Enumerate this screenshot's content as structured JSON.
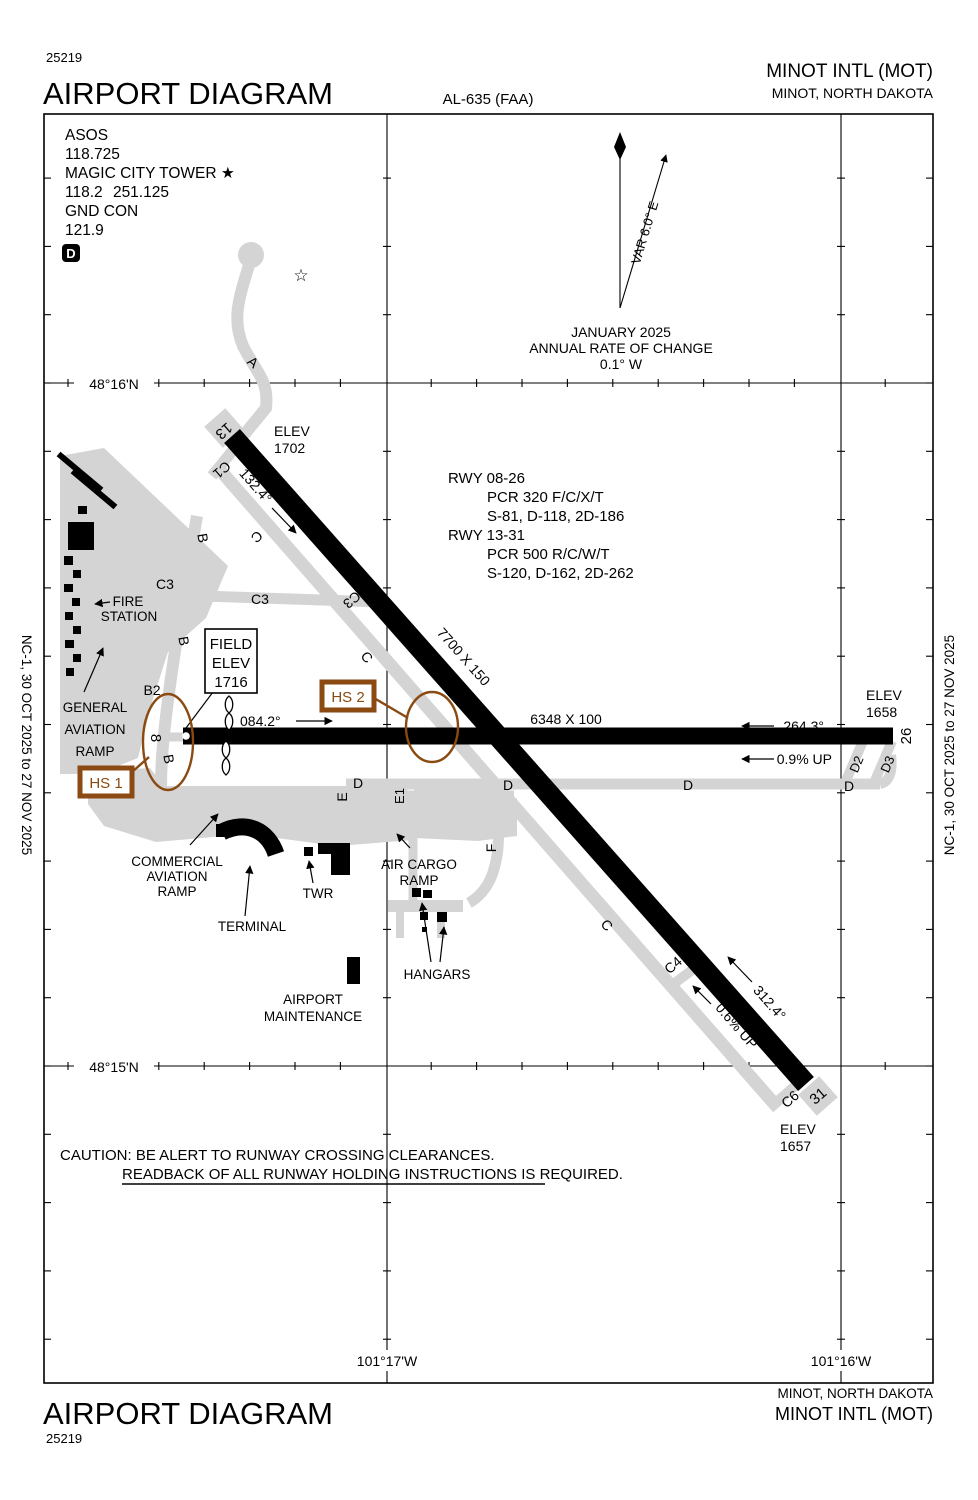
{
  "header": {
    "edition": "25219",
    "title": "AIRPORT DIAGRAM",
    "chart_id": "AL-635 (FAA)",
    "airport": "MINOT INTL (MOT)",
    "city": "MINOT, NORTH DAKOTA"
  },
  "footer": {
    "title": "AIRPORT DIAGRAM",
    "edition": "25219",
    "city": "MINOT, NORTH DAKOTA",
    "airport": "MINOT INTL (MOT)"
  },
  "margins": {
    "left": "NC-1,  30 OCT 2025  to  27 NOV 2025",
    "right": "NC-1,  30 OCT 2025  to  27 NOV 2025"
  },
  "comm": {
    "asos_label": "ASOS",
    "asos_freq": "118.725",
    "twr_label": "MAGIC CITY TOWER ★",
    "twr_freq": "118.2 251.125",
    "gnd_label": "GND CON",
    "gnd_freq": "121.9",
    "badge": "D"
  },
  "north": {
    "var": "VAR 6.0° E",
    "date": "JANUARY 2025",
    "roc": "ANNUAL RATE OF CHANGE",
    "rate": "0.1° W"
  },
  "graticule": {
    "lat_n": "48°16'N",
    "lat_s": "48°15'N",
    "lon_w": "101°17'W",
    "lon_e": "101°16'W"
  },
  "rwy_info": {
    "l1": "RWY 08-26",
    "l2": "PCR 320 F/C/X/T",
    "l3": "S-81, D-118, 2D-186",
    "l4": "RWY 13-31",
    "l5": "PCR 500 R/C/W/T",
    "l6": "S-120, D-162, 2D-262"
  },
  "caution": {
    "l1": "CAUTION: BE ALERT TO RUNWAY CROSSING CLEARANCES.",
    "l2": "READBACK OF ALL RUNWAY HOLDING INSTRUCTIONS IS REQUIRED."
  },
  "runways": {
    "r1331": {
      "num13": "13",
      "num31": "31",
      "dim": "7700 X 150",
      "hdg13": "132.4°",
      "hdg31": "312.4°",
      "slope": "0.6% UP",
      "elev13a": "ELEV",
      "elev13b": "1702",
      "elev31a": "ELEV",
      "elev31b": "1657"
    },
    "r0826": {
      "num8": "8",
      "num26": "26",
      "dim": "6348 X 100",
      "hdg08": "084.2°",
      "hdg26": "264.3°",
      "slope": "0.9% UP",
      "elev26a": "ELEV",
      "elev26b": "1658"
    }
  },
  "field_elev": {
    "l1": "FIELD",
    "l2": "ELEV",
    "l3": "1716"
  },
  "hotspots": {
    "hs1": "HS 1",
    "hs2": "HS 2"
  },
  "twy": {
    "a": "A",
    "b1": "B",
    "b2lbl": "B2",
    "b3": "B",
    "b4": "B",
    "c1": "C1",
    "c2": "C",
    "c3w": "C3",
    "c3e": "C3",
    "c3r": "C3",
    "c4": "C4",
    "c5": "C",
    "c6": "C6",
    "c7": "C",
    "d1": "D",
    "d2": "D",
    "d3": "D",
    "d4": "D",
    "d2r": "D2",
    "d3r": "D3",
    "e": "E",
    "e1": "E1",
    "f": "F"
  },
  "fac": {
    "fire1": "FIRE",
    "fire2": "STATION",
    "ga1": "GENERAL",
    "ga2": "AVIATION",
    "ga3": "RAMP",
    "com1": "COMMERCIAL",
    "com2": "AVIATION",
    "com3": "RAMP",
    "terminal": "TERMINAL",
    "twr": "TWR",
    "cargo1": "AIR CARGO",
    "cargo2": "RAMP",
    "hangars": "HANGARS",
    "maint1": "AIRPORT",
    "maint2": "MAINTENANCE"
  },
  "icons": {
    "beacon": "☆"
  },
  "colors": {
    "hotspot": "#8a4a12",
    "taxiway": "#d4d4d4",
    "runway": "#000000"
  }
}
